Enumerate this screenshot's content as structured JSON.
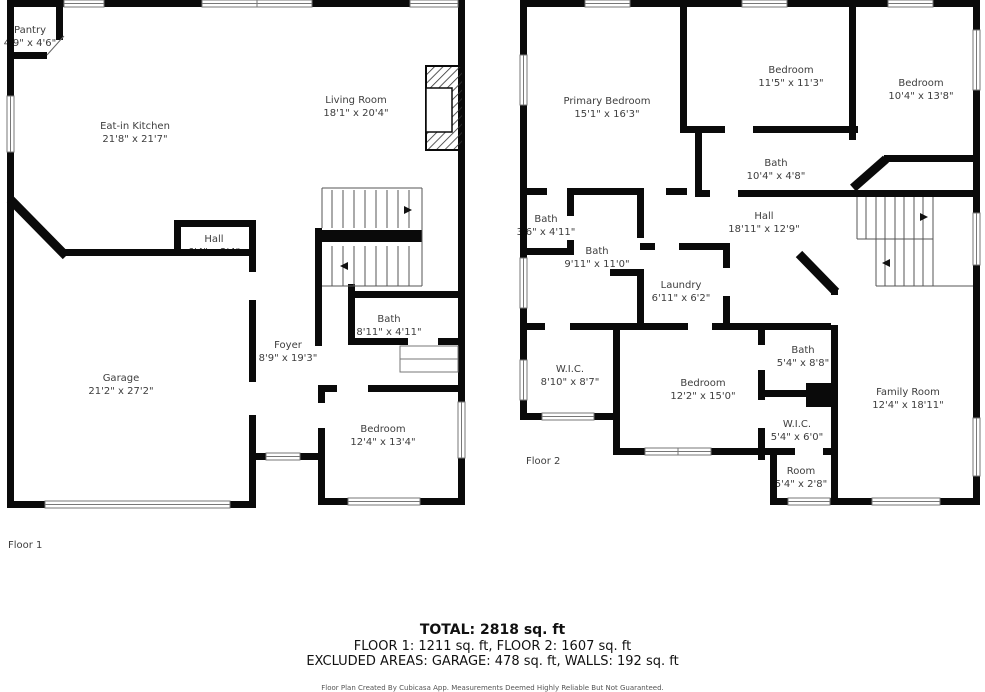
{
  "colors": {
    "wall": "#0a0a0a",
    "label_text": "#3d3d3d",
    "summary_text": "#111111",
    "disclaimer_text": "#555555",
    "background": "#ffffff"
  },
  "floor1": {
    "label": "Floor 1",
    "rooms": [
      {
        "name": "Pantry",
        "dims": "4'9\" x 4'6\""
      },
      {
        "name": "Eat-in Kitchen",
        "dims": "21'8\" x 21'7\""
      },
      {
        "name": "Living Room",
        "dims": "18'1\" x 20'4\""
      },
      {
        "name": "Hall",
        "dims": "6'4\" x 2'4\""
      },
      {
        "name": "Garage",
        "dims": "21'2\" x 27'2\""
      },
      {
        "name": "Foyer",
        "dims": "8'9\" x 19'3\""
      },
      {
        "name": "Bath",
        "dims": "8'11\" x 4'11\""
      },
      {
        "name": "Bedroom",
        "dims": "12'4\" x 13'4\""
      }
    ]
  },
  "floor2": {
    "label": "Floor 2",
    "rooms": [
      {
        "name": "Primary Bedroom",
        "dims": "15'1\" x 16'3\""
      },
      {
        "name": "Bedroom",
        "dims": "11'5\" x 11'3\""
      },
      {
        "name": "Bedroom",
        "dims": "10'4\" x 13'8\""
      },
      {
        "name": "Bath",
        "dims": "10'4\" x 4'8\""
      },
      {
        "name": "Bath",
        "dims": "3'6\" x 4'11\""
      },
      {
        "name": "Bath",
        "dims": "9'11\" x 11'0\""
      },
      {
        "name": "Hall",
        "dims": "18'11\" x 12'9\""
      },
      {
        "name": "Laundry",
        "dims": "6'11\" x 6'2\""
      },
      {
        "name": "W.I.C.",
        "dims": "8'10\" x 8'7\""
      },
      {
        "name": "Bedroom",
        "dims": "12'2\" x 15'0\""
      },
      {
        "name": "Bath",
        "dims": "5'4\" x 8'8\""
      },
      {
        "name": "W.I.C.",
        "dims": "5'4\" x 6'0\""
      },
      {
        "name": "Room",
        "dims": "5'4\" x 2'8\""
      },
      {
        "name": "Family Room",
        "dims": "12'4\" x 18'11\""
      }
    ]
  },
  "summary": {
    "total": "TOTAL: 2818 sq. ft",
    "floors": "FLOOR 1: 1211 sq. ft, FLOOR 2: 1607 sq. ft",
    "excluded": "EXCLUDED AREAS: GARAGE: 478 sq. ft, WALLS: 192 sq. ft",
    "disclaimer": "Floor Plan Created By Cubicasa App. Measurements Deemed Highly Reliable But Not Guaranteed."
  }
}
